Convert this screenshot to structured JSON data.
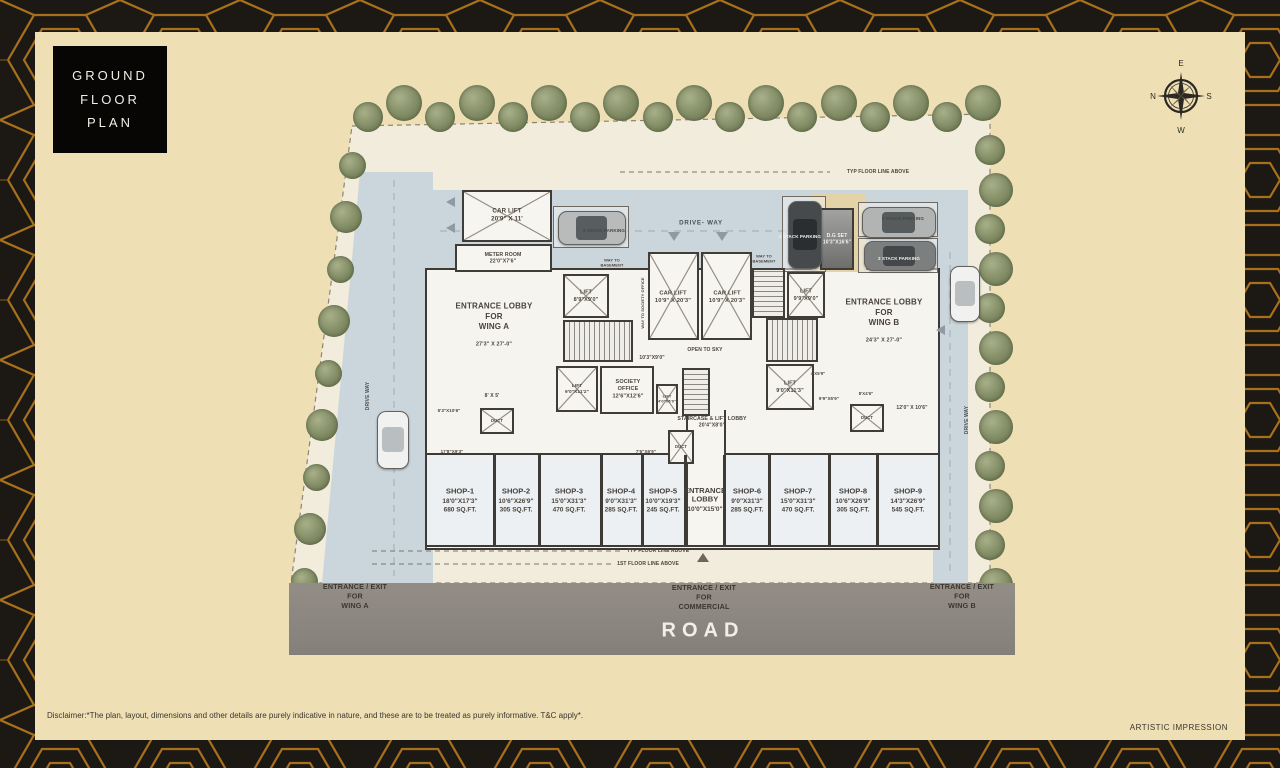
{
  "title_block": {
    "text": "GROUND\nFLOOR\nPLAN"
  },
  "compass": {
    "n": "N",
    "e": "E",
    "s": "S",
    "w": "W"
  },
  "labels": {
    "drive_way_top": "DRIVE- WAY",
    "drive_way_vert": "DRIVE WAY",
    "stack_parking": "2 STACK PARKING",
    "way_to_basement": "WAY TO\nBASEMENT",
    "way_to_society": "WAY TO SOCIETY OFFICE",
    "open_to_sky": "OPEN TO SKY",
    "typ_floor_line": "TYP FLOOR LINE ABOVE",
    "first_floor_line": "1ST FLOOR LINE ABOVE",
    "duct": "DUCT"
  },
  "rooms": {
    "car_lift_top": "CAR LIFT\n20'9\" X 11'",
    "meter_room": "METER ROOM\n22'0\"X7'6\"",
    "dg_set": "D.G SET\n10'3\"X16'6\"",
    "lobby_a_title": "ENTRANCE LOBBY\nFOR\nWING A",
    "lobby_a_dims": "27'3\" X 27'-0\"",
    "lobby_b_title": "ENTRANCE LOBBY\nFOR\nWING B",
    "lobby_b_dims": "24'3\" X 27'-0\"",
    "lift_a": "LIFT\n8'9\"X9'0\"",
    "car_lift_mid": "CAR LIFT\n10'9\" X 20'3\"",
    "lift_mid": "LIFT\n9'9\"X9'0\"",
    "society_lift": "LIFT\n9'0\"X11'2\"",
    "society_office": "SOCIETY\nOFFICE\n12'6\"X12'6\"",
    "small_lift": "LIFT\n4'0\"X6'0\"",
    "stair_lobby": "STAIRCASE & LIFT LOBBY\n20'4\"X8'0\"",
    "lift_b": "LIFT\n9'0\"X11'3\""
  },
  "dims": {
    "d1": "8' X 5'",
    "d2": "5'3\"X10'6\"",
    "d3": "17'8\"X9'3\"",
    "d4": "10'3\"X9'0\"",
    "d5": "4'X5'9\"",
    "d6": "9'9\"X5'9\"",
    "d7": "8'X4'6\"",
    "d8": "12'0\" X 10'6\"",
    "d9": "7'6\"X6'9\""
  },
  "shops": [
    {
      "name": "SHOP-1",
      "dims": "18'0\"X17'3\"",
      "area": "680 SQ.FT."
    },
    {
      "name": "SHOP-2",
      "dims": "10'6\"X26'9\"",
      "area": "305 SQ.FT."
    },
    {
      "name": "SHOP-3",
      "dims": "15'0\"X31'3\"",
      "area": "470 SQ.FT."
    },
    {
      "name": "SHOP-4",
      "dims": "9'0\"X31'3\"",
      "area": "285 SQ.FT."
    },
    {
      "name": "SHOP-5",
      "dims": "10'0\"X19'3\"",
      "area": "245 SQ.FT."
    },
    {
      "name": "ENTRANCE\nLOBBY",
      "dims": "10'0\"X15'0\"",
      "area": ""
    },
    {
      "name": "SHOP-6",
      "dims": "9'0\"X31'3\"",
      "area": "285 SQ.FT."
    },
    {
      "name": "SHOP-7",
      "dims": "15'0\"X31'3\"",
      "area": "470 SQ.FT."
    },
    {
      "name": "SHOP-8",
      "dims": "10'6\"X26'9\"",
      "area": "305 SQ.FT."
    },
    {
      "name": "SHOP-9",
      "dims": "14'3\"X26'9\"",
      "area": "545 SQ.FT."
    }
  ],
  "road": {
    "wing_a": "ENTRANCE / EXIT\nFOR\nWING A",
    "commercial": "ENTRANCE / EXIT\nFOR\nCOMMERCIAL",
    "wing_b": "ENTRANCE / EXIT\nFOR\nWING B",
    "name": "ROAD"
  },
  "footer": {
    "disclaimer": "Disclaimer:*The plan, layout, dimensions and other details are purely indicative in nature, and these are to be treated as purely informative. T&C apply*.",
    "artistic": "ARTISTIC IMPRESSION"
  },
  "colors": {
    "accent_gold": "#b4771f",
    "cream": "#eedfb4",
    "driveway": "#cbd6dc",
    "road": "#8e8881",
    "wall": "#3e3a35",
    "tree": "#7d865f"
  }
}
